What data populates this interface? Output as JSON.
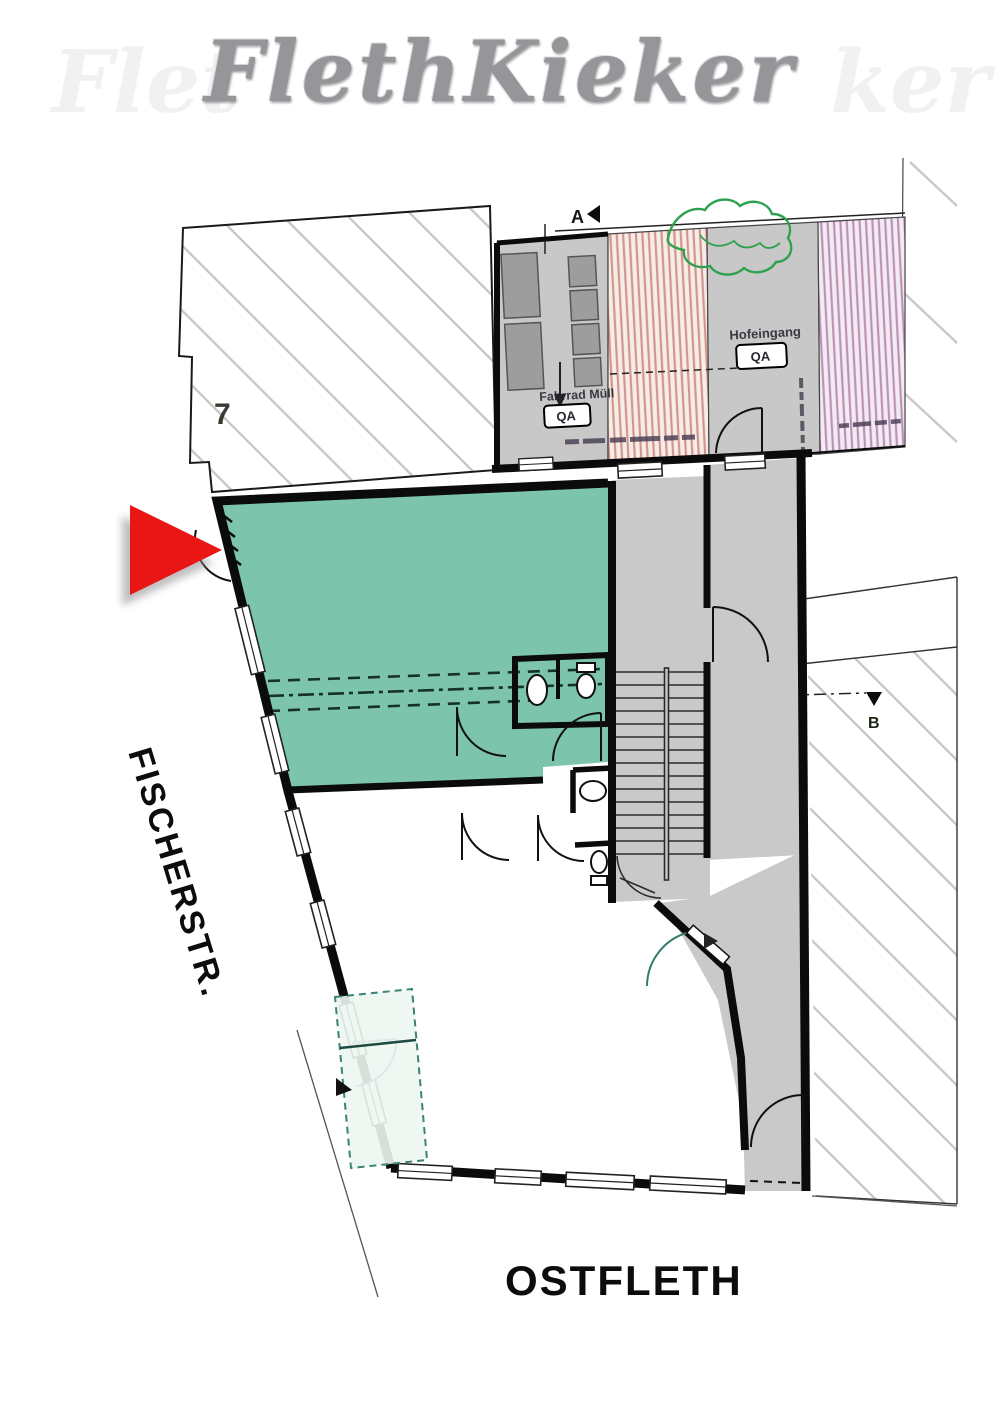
{
  "title": {
    "main": "FlethKieker",
    "watermark_left": "Flet",
    "watermark_right": "ker"
  },
  "streets": {
    "left": "FISCHERSTR.",
    "bottom": "OSTFLETH"
  },
  "plan": {
    "house_number": "7",
    "marker_a": "A",
    "marker_b": "B",
    "bike_label": "Fahrrad Müll",
    "bike_tag": "QA",
    "entrance_label": "Hofeingang",
    "entrance_tag": "QA",
    "colors": {
      "highlight_unit_fill": "#7cc4ab",
      "circulation_fill": "#c9c9c9",
      "neighbor_stripe_pink": "#d2968b",
      "neighbor_stripe_purple": "#bd92ba",
      "tree_green": "#2fa14e",
      "arrow_red": "#ea1515",
      "wall_black": "#0b0b0b"
    }
  }
}
